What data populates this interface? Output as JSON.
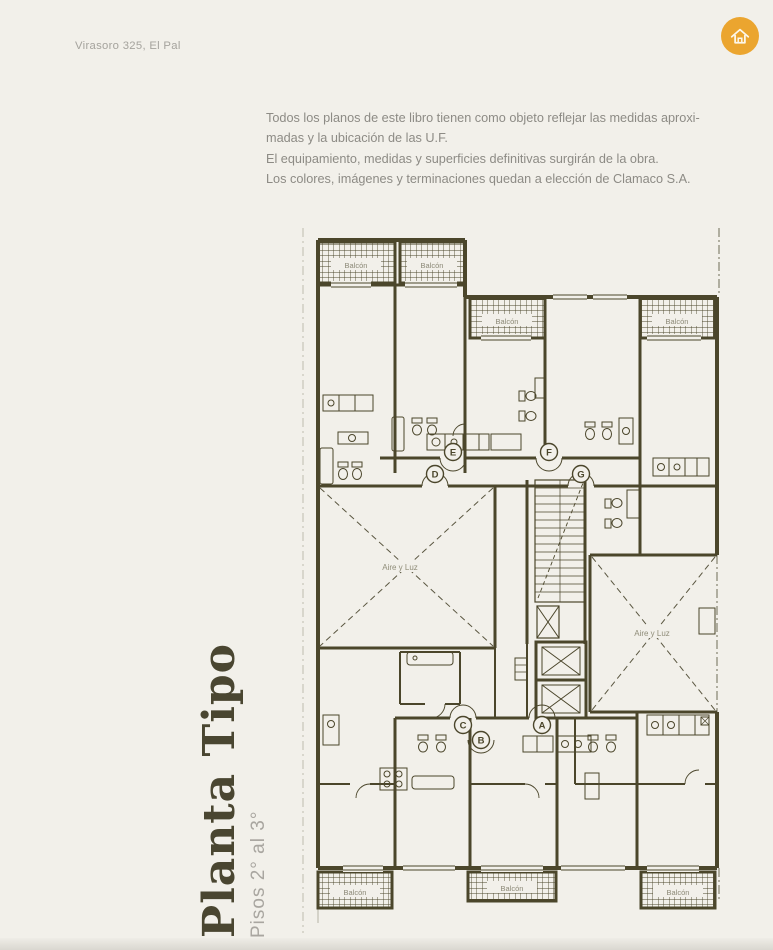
{
  "header": {
    "location_label": "Virasoro 325, El Pal"
  },
  "home_button": {
    "icon": "home-icon",
    "color": "#EBA52F"
  },
  "disclaimer": {
    "lines": [
      "Todos los planos de este libro tienen como objeto reflejar las medidas aproxi-",
      "madas y la ubicación de las U.F.",
      "El equipamiento, medidas y superficies definitivas surgirán de la obra.",
      "Los colores, imágenes y terminaciones quedan a elección de Clamaco S.A."
    ]
  },
  "sidebar_title": {
    "title": "Planta Tipo",
    "subtitle": "Pisos 2° al 3°"
  },
  "plan": {
    "balconies": [
      "Balcón",
      "Balcón",
      "Balcón",
      "Balcón",
      "Balcón",
      "Balcón",
      "Balcón"
    ],
    "courtyards": [
      "Aire y Luz",
      "Aire y Luz"
    ],
    "units": [
      "D",
      "E",
      "F",
      "G",
      "C",
      "A",
      "B"
    ],
    "colors": {
      "wall": "#4B462B",
      "background": "#F2F0EA",
      "home_accent": "#EBA52F"
    }
  }
}
